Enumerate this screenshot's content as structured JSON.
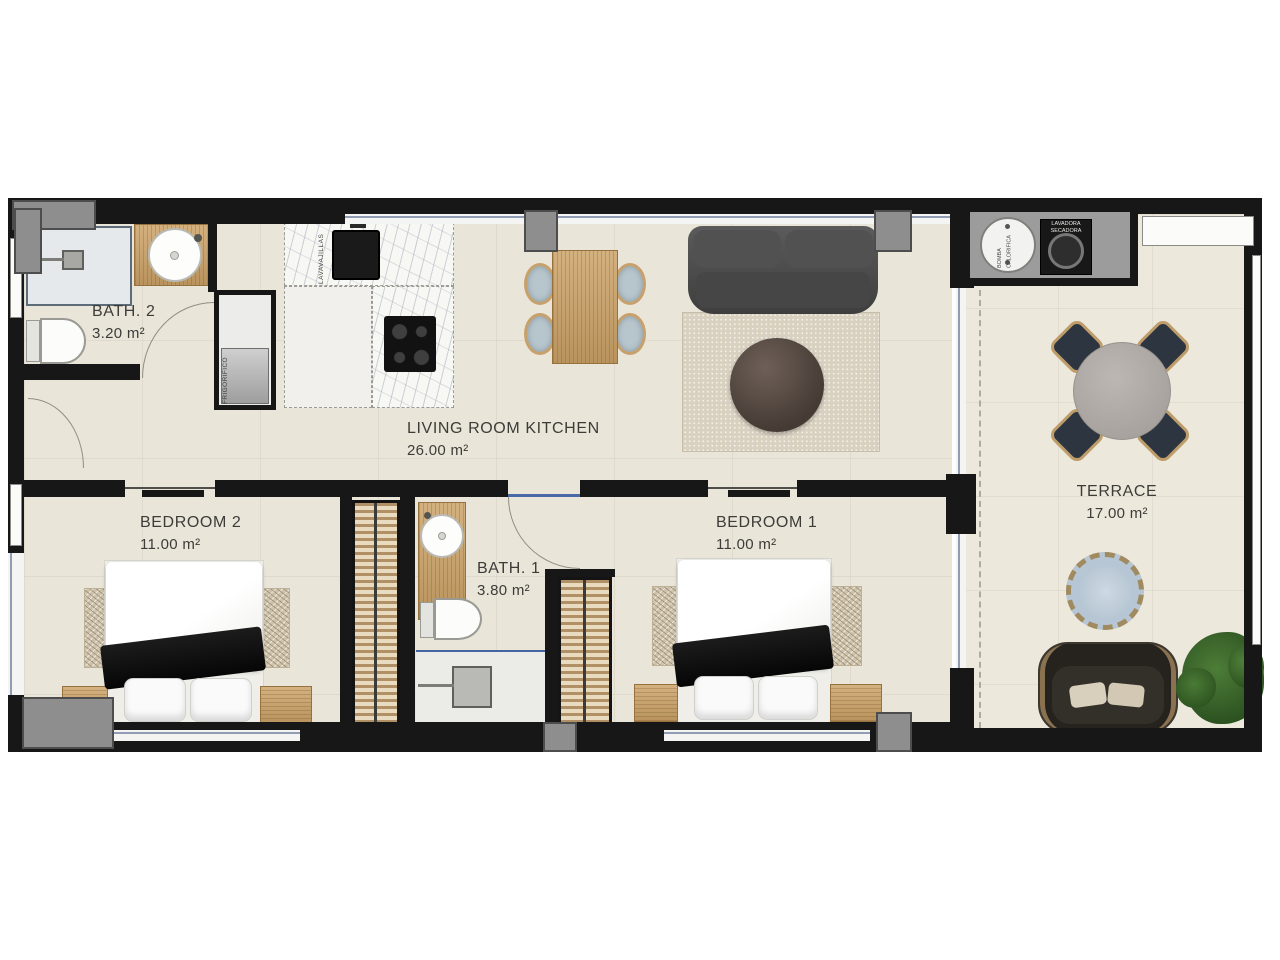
{
  "rooms": {
    "bath2": {
      "name": "BATH. 2",
      "area": "3.20 m²"
    },
    "living": {
      "name": "LIVING ROOM KITCHEN",
      "area": "26.00 m²"
    },
    "bedroom2": {
      "name": "BEDROOM 2",
      "area": "11.00 m²"
    },
    "bath1": {
      "name": "BATH. 1",
      "area": "3.80 m²"
    },
    "bedroom1": {
      "name": "BEDROOM 1",
      "area": "11.00 m²"
    },
    "terrace": {
      "name": "TERRACE",
      "area": "17.00 m²"
    }
  },
  "appliances": {
    "fridge": "FRIGORIFICO",
    "dishwasher": "LAVAVAJILLAS",
    "heat_pump": "BOMBA CALORIFICA",
    "washer_dryer": "LAVADORA SECADORA"
  },
  "colors": {
    "wall": "#171717",
    "floor": "#e9e5d9",
    "terrace_floor": "#ece8dc",
    "wood": "#cba267",
    "sofa": "#4a4a4a",
    "glazing": "#8f9cb3"
  }
}
